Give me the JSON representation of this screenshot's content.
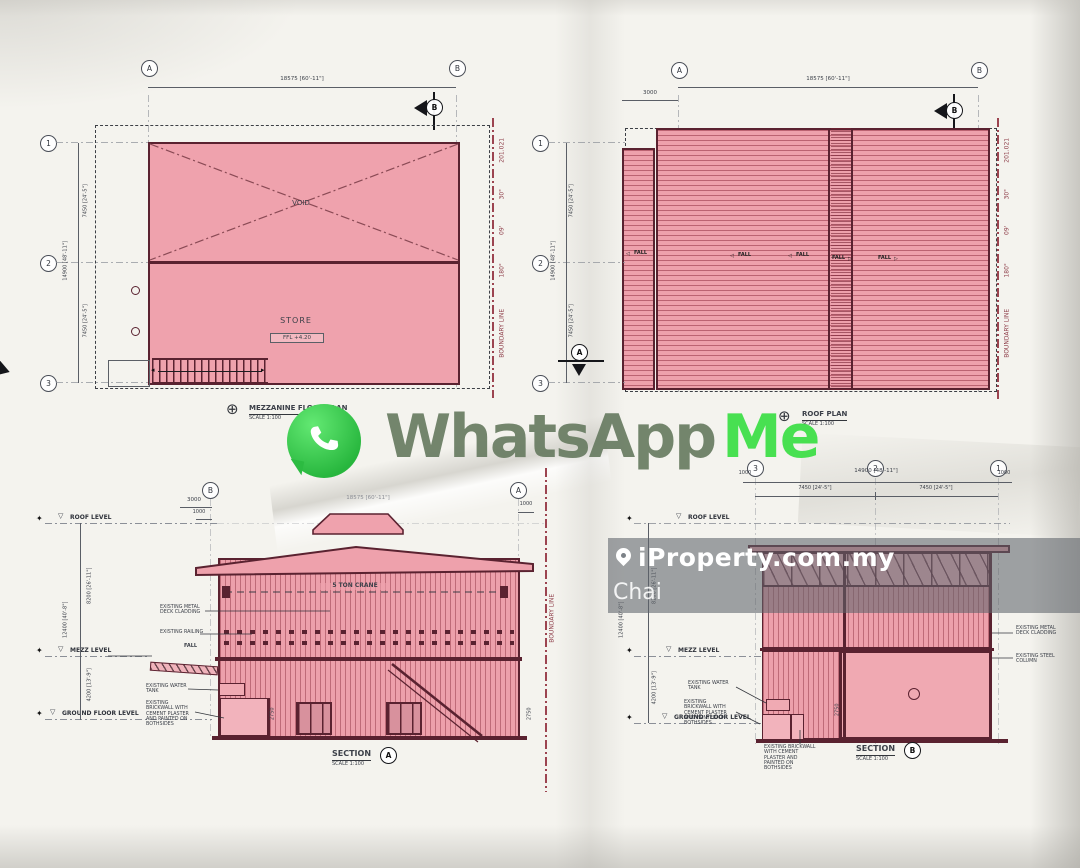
{
  "icons": {
    "arrow_left": "◁",
    "arrow_right": "▷",
    "level_triangle": "▽",
    "diamond": "✦",
    "compass": "⊕"
  },
  "watermarks": {
    "whatsapp": {
      "word1": "WhatsApp",
      "word2": "Me"
    },
    "iproperty": {
      "brand": "iProperty.com.my",
      "agent": "Chai"
    }
  },
  "boundary": {
    "label": "BOUNDARY LINE",
    "deg": "180°",
    "min": "09'",
    "sec": "30\"",
    "dist": "201.021"
  },
  "mezzanine_plan": {
    "title": "MEZZANINE FLOOR PLAN",
    "scale": "SCALE 1:100",
    "grid_a": "A",
    "grid_b": "B",
    "grid_1": "1",
    "grid_2": "2",
    "grid_3": "3",
    "dim_top": "18575 [60'-11\"]",
    "dim_left_overall": "14900 [48'-11\"]",
    "dim_left_seg": "7450 [24'-5\"]",
    "void": "VOID",
    "store": "STORE",
    "ffl": "FFL +4.20",
    "flag_letter": "B"
  },
  "roof_plan": {
    "title": "ROOF PLAN",
    "scale": "SCALE 1:100",
    "grid_a": "A",
    "grid_b": "B",
    "grid_1": "1",
    "grid_2": "2",
    "grid_3": "3",
    "dim_top": "18575 [60'-11\"]",
    "dim_canopy": "3000",
    "dim_left_overall": "14900 [48'-11\"]",
    "dim_left_seg": "7450 [24'-5\"]",
    "fall": "FALL",
    "flag_a": "A",
    "flag_b": "B"
  },
  "section_a": {
    "title": "SECTION",
    "flag": "A",
    "scale": "SCALE 1:100",
    "grid_b": "B",
    "grid_a": "A",
    "dim_3000": "3000",
    "dim_1000": "1000",
    "dim_top": "18575 [60'-11\"]",
    "lvl_roof": "ROOF LEVEL",
    "lvl_mezz": "MEZZ LEVEL",
    "lvl_ground": "GROUND FLOOR LEVEL",
    "dim_upper": "8200 [26'-11\"]",
    "dim_lower": "4200 [13'-9\"]",
    "dim_overall": "12400 [40'-8\"]",
    "dim_2750": "2750",
    "crane": "5 TON CRANE",
    "ann_cladding": "EXISTING METAL DECK CLADDING",
    "ann_railing": "EXISTING RAILING",
    "ann_fall": "FALL",
    "ann_tank": "EXISTING WATER TANK",
    "ann_brick": "EXISTING BRICKWALL WITH CEMENT PLASTER AND PAINTED ON BOTHSIDES",
    "boundary_label": "BOUNDARY LINE"
  },
  "section_b": {
    "title": "SECTION",
    "flag": "B",
    "scale": "SCALE 1:100",
    "grid_3": "3",
    "grid_2": "2",
    "grid_1": "1",
    "dim_top": "14900 [48'-11\"]",
    "dim_seg": "7450 [24'-5\"]",
    "dim_1000": "1000",
    "lvl_roof": "ROOF LEVEL",
    "lvl_mezz": "MEZZ LEVEL",
    "lvl_ground": "GROUND FLOOR LEVEL",
    "dim_upper": "8200 [26'-11\"]",
    "dim_lower": "4200 [13'-9\"]",
    "dim_overall": "12400 [40'-8\"]",
    "dim_2750": "2750",
    "ann_cladding": "EXISTING METAL DECK CLADDING",
    "ann_column": "EXISTING STEEL COLUMN",
    "ann_tank": "EXISTING WATER TANK",
    "ann_brick": "EXISTING BRICKWALL WITH CEMENT PLASTER AND PAINTED ON BOTHSIDES"
  }
}
